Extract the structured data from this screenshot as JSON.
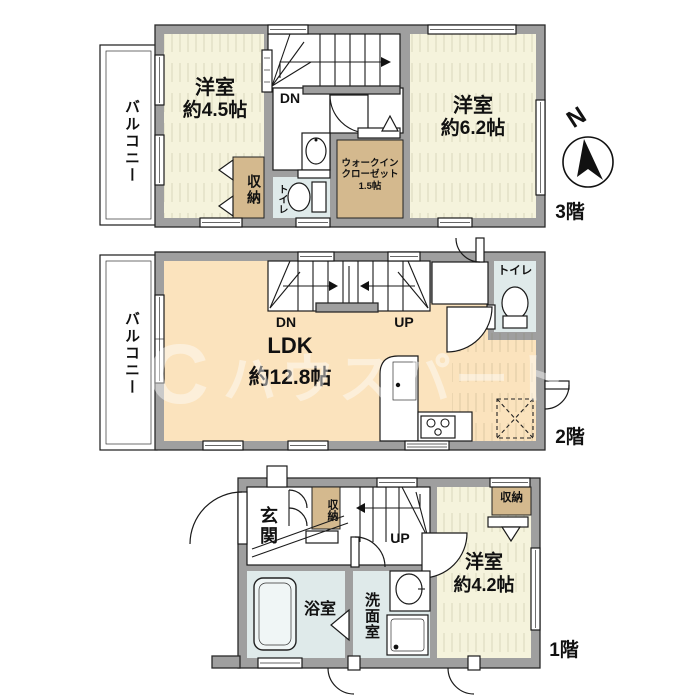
{
  "watermark": {
    "logo": "C",
    "text": "ハウスパートナー"
  },
  "compass": {
    "north": "N"
  },
  "colors": {
    "wall": "#9f9f9f",
    "room": "#f5f3dc",
    "ldk": "#fbe3bd",
    "storage": "#d4b98e",
    "wet": "#dfeaea"
  },
  "f3": {
    "floor": "3階",
    "balcony": "バルコニー",
    "room_a_name": "洋室",
    "room_a_size": "約4.5帖",
    "closet": "収納",
    "dn": "DN",
    "toilet": "トイレ",
    "wic_1": "ウォークイン",
    "wic_2": "クローゼット",
    "wic_3": "1.5帖",
    "room_b_name": "洋室",
    "room_b_size": "約6.2帖"
  },
  "f2": {
    "floor": "2階",
    "balcony": "バルコニー",
    "dn": "DN",
    "up": "UP",
    "toilet": "トイレ",
    "ldk_name": "LDK",
    "ldk_size": "約12.8帖"
  },
  "f1": {
    "floor": "1階",
    "genkan": "玄関",
    "hall_closet": "収納",
    "up": "UP",
    "room_name": "洋室",
    "room_size": "約4.2帖",
    "room_closet": "収納",
    "bath": "浴室",
    "washroom": "洗面室"
  }
}
